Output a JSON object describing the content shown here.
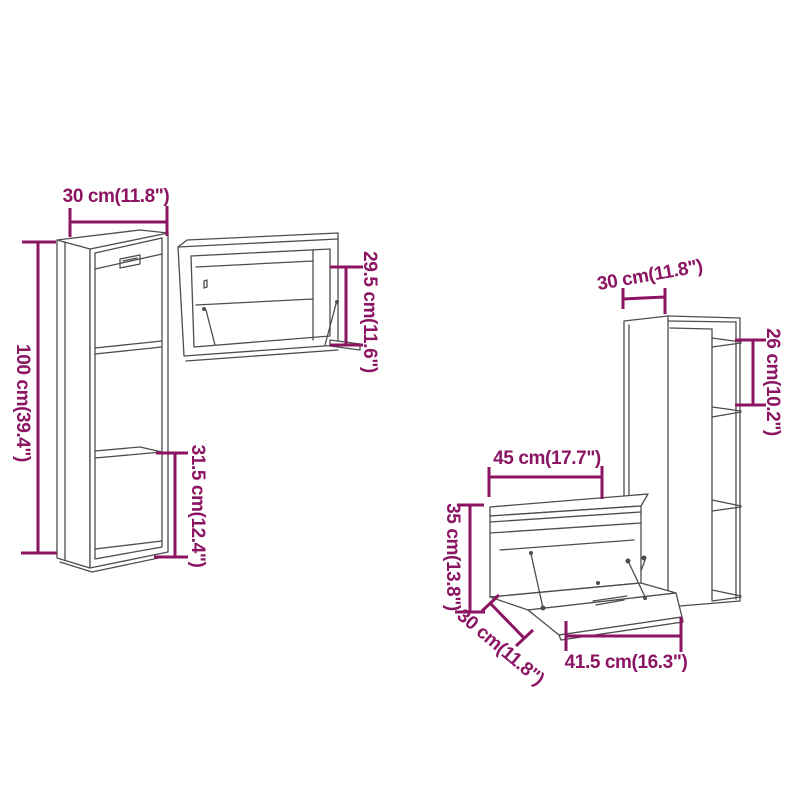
{
  "figure": {
    "type": "product-dimension-diagram",
    "subject": "4-piece wall cabinet set with dimension annotations"
  },
  "labels": {
    "left_width": "30 cm(11.8\")",
    "left_height": "100 cm(39.4\")",
    "left_compartment": "31.5 cm(12.4\")",
    "top_height": "29.5 cm(11.6\")",
    "right_width": "30 cm(11.8\")",
    "right_compartment": "26 cm(10.2\")",
    "bottom_width": "45 cm(17.7\")",
    "bottom_height": "35 cm(13.8\")",
    "bottom_depth": "30 cm(11.8\")",
    "bottom_door_width": "41.5 cm(16.3\")"
  },
  "colors": {
    "dimension": "#8c1563",
    "line_art": "#4d4d4d",
    "background": "#ffffff"
  }
}
